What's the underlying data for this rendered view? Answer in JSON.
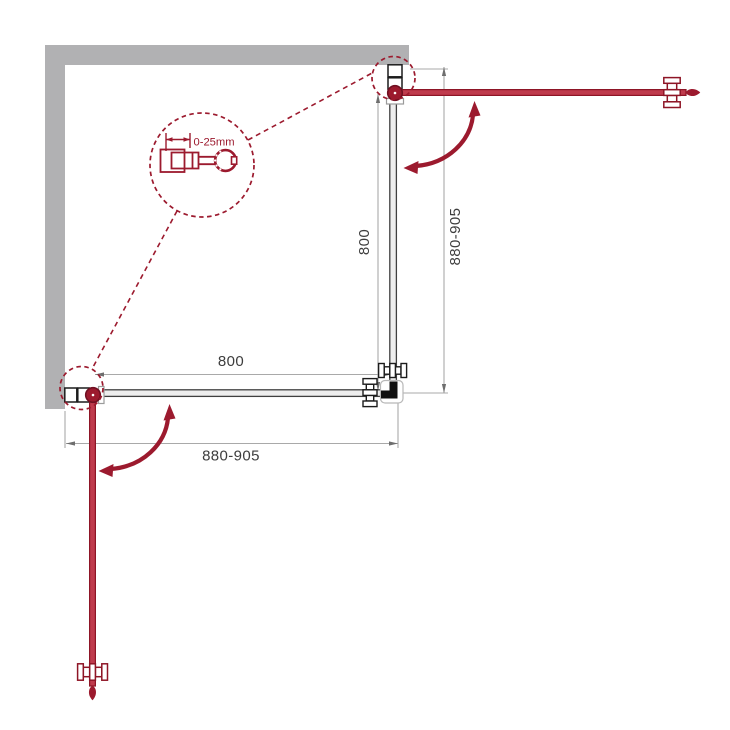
{
  "diagram": {
    "type": "shower-enclosure-corner-plan",
    "detail": {
      "adjustment_label": "0-25mm"
    },
    "dimensions": {
      "bottom": {
        "panel": "800",
        "overall": "880-905"
      },
      "right": {
        "panel": "800",
        "overall": "880-905"
      }
    },
    "colors": {
      "accent_red": "#9c1a2e",
      "door_fill_red": "#bf3b4d",
      "wall_gray": "#b1b1b3",
      "glass_line": "#3f3f3f",
      "dimension_gray": "#a9a9a9",
      "label_text": "#3d3d3d",
      "background": "#ffffff"
    }
  }
}
